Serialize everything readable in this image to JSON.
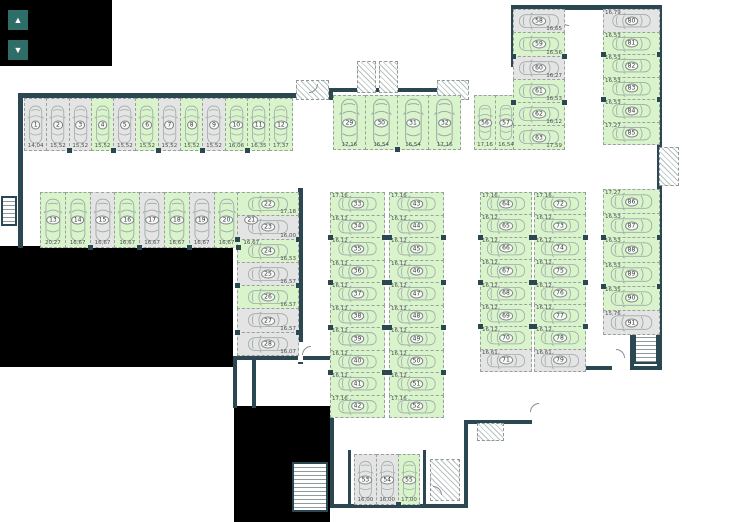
{
  "title": "underground-parking-floor-plan",
  "colors": {
    "wall": "#2b4751",
    "available": "#d9f3cb",
    "occupied": "#e4e4e4",
    "control_button": "#2f6e68",
    "background": "#ffffff"
  },
  "controls": {
    "up_glyph": "▲",
    "down_glyph": "▼"
  },
  "floor": {
    "groups": [
      {
        "id": "row1",
        "orient": "v",
        "stalls": [
          {
            "n": "1",
            "area": "14,04",
            "status": "occupied"
          },
          {
            "n": "2",
            "area": "15,52",
            "status": "occupied"
          },
          {
            "n": "3",
            "area": "15,52",
            "status": "occupied"
          },
          {
            "n": "4",
            "area": "15,52",
            "status": "available"
          },
          {
            "n": "5",
            "area": "15,52",
            "status": "occupied"
          },
          {
            "n": "6",
            "area": "15,52",
            "status": "available"
          },
          {
            "n": "7",
            "area": "15,52",
            "status": "occupied"
          },
          {
            "n": "8",
            "area": "15,52",
            "status": "available"
          },
          {
            "n": "9",
            "area": "15,52",
            "status": "occupied"
          },
          {
            "n": "10",
            "area": "16,06",
            "status": "available"
          },
          {
            "n": "11",
            "area": "16,35",
            "status": "available"
          },
          {
            "n": "12",
            "area": "17,37",
            "status": "available"
          }
        ]
      },
      {
        "id": "row2",
        "orient": "v",
        "stalls": [
          {
            "n": "13",
            "area": "20,27",
            "status": "available"
          },
          {
            "n": "14",
            "area": "16,67",
            "status": "available"
          },
          {
            "n": "15",
            "area": "16,67",
            "status": "occupied"
          },
          {
            "n": "16",
            "area": "16,67",
            "status": "available"
          },
          {
            "n": "17",
            "area": "16,67",
            "status": "occupied"
          },
          {
            "n": "18",
            "area": "16,67",
            "status": "available"
          },
          {
            "n": "19",
            "area": "16,67",
            "status": "occupied"
          },
          {
            "n": "20",
            "area": "16,67",
            "status": "available"
          },
          {
            "n": "21",
            "area": "16,67",
            "status": "occupied"
          }
        ]
      },
      {
        "id": "col22",
        "orient": "h",
        "stalls": [
          {
            "n": "22",
            "area": "17,18",
            "status": "available"
          },
          {
            "n": "23",
            "area": "16,00",
            "status": "occupied"
          },
          {
            "n": "24",
            "area": "16,53",
            "status": "available"
          },
          {
            "n": "25",
            "area": "16,57",
            "status": "occupied"
          },
          {
            "n": "26",
            "area": "16,57",
            "status": "available"
          },
          {
            "n": "27",
            "area": "16,57",
            "status": "occupied"
          },
          {
            "n": "28",
            "area": "16,07",
            "status": "occupied"
          }
        ]
      },
      {
        "id": "row29",
        "orient": "v",
        "stalls": [
          {
            "n": "29",
            "area": "17,16",
            "status": "available"
          },
          {
            "n": "30",
            "area": "16,54",
            "status": "available"
          },
          {
            "n": "31",
            "area": "16,54",
            "status": "available"
          },
          {
            "n": "32",
            "area": "17,16",
            "status": "available"
          }
        ]
      },
      {
        "id": "row56",
        "orient": "v",
        "stalls": [
          {
            "n": "56",
            "area": "17,16",
            "status": "available"
          },
          {
            "n": "57",
            "area": "16,54",
            "status": "available"
          }
        ]
      },
      {
        "id": "col58",
        "orient": "h",
        "stalls": [
          {
            "n": "58",
            "area": "16,65",
            "status": "occupied"
          },
          {
            "n": "59",
            "area": "16,56",
            "status": "available"
          },
          {
            "n": "60",
            "area": "16,27",
            "status": "occupied"
          },
          {
            "n": "61",
            "area": "16,53",
            "status": "available"
          },
          {
            "n": "62",
            "area": "16,12",
            "status": "available"
          },
          {
            "n": "63",
            "area": "17,59",
            "status": "available"
          }
        ]
      },
      {
        "id": "col80",
        "orient": "h",
        "stalls": [
          {
            "n": "80",
            "area": "16,79",
            "status": "occupied"
          },
          {
            "n": "81",
            "area": "16,53",
            "status": "available"
          },
          {
            "n": "82",
            "area": "16,53",
            "status": "available"
          },
          {
            "n": "83",
            "area": "16,53",
            "status": "available"
          },
          {
            "n": "84",
            "area": "16,53",
            "status": "available"
          },
          {
            "n": "85",
            "area": "17,27",
            "status": "available"
          }
        ]
      },
      {
        "id": "col33",
        "orient": "h",
        "stalls": [
          {
            "n": "33",
            "area": "17,16",
            "status": "available"
          },
          {
            "n": "34",
            "area": "16,12",
            "status": "available"
          },
          {
            "n": "35",
            "area": "16,12",
            "status": "available"
          },
          {
            "n": "36",
            "area": "16,12",
            "status": "available"
          },
          {
            "n": "37",
            "area": "16,12",
            "status": "available"
          },
          {
            "n": "38",
            "area": "16,12",
            "status": "available"
          },
          {
            "n": "39",
            "area": "16,12",
            "status": "available"
          },
          {
            "n": "40",
            "area": "16,12",
            "status": "available"
          },
          {
            "n": "41",
            "area": "16,12",
            "status": "available"
          },
          {
            "n": "42",
            "area": "17,16",
            "status": "available"
          }
        ]
      },
      {
        "id": "col43",
        "orient": "h",
        "stalls": [
          {
            "n": "43",
            "area": "17,16",
            "status": "available"
          },
          {
            "n": "44",
            "area": "16,12",
            "status": "available"
          },
          {
            "n": "45",
            "area": "16,12",
            "status": "available"
          },
          {
            "n": "46",
            "area": "16,12",
            "status": "available"
          },
          {
            "n": "47",
            "area": "16,12",
            "status": "available"
          },
          {
            "n": "48",
            "area": "16,12",
            "status": "available"
          },
          {
            "n": "49",
            "area": "16,12",
            "status": "available"
          },
          {
            "n": "50",
            "area": "16,12",
            "status": "available"
          },
          {
            "n": "51",
            "area": "16,12",
            "status": "available"
          },
          {
            "n": "52",
            "area": "17,16",
            "status": "available"
          }
        ]
      },
      {
        "id": "col64",
        "orient": "h",
        "stalls": [
          {
            "n": "64",
            "area": "17,16",
            "status": "available"
          },
          {
            "n": "65",
            "area": "16,12",
            "status": "available"
          },
          {
            "n": "66",
            "area": "16,12",
            "status": "available"
          },
          {
            "n": "67",
            "area": "16,12",
            "status": "available"
          },
          {
            "n": "68",
            "area": "16,12",
            "status": "available"
          },
          {
            "n": "69",
            "area": "16,12",
            "status": "available"
          },
          {
            "n": "70",
            "area": "16,12",
            "status": "available"
          },
          {
            "n": "71",
            "area": "16,61",
            "status": "occupied"
          }
        ]
      },
      {
        "id": "col72",
        "orient": "h",
        "stalls": [
          {
            "n": "72",
            "area": "17,16",
            "status": "available"
          },
          {
            "n": "73",
            "area": "16,12",
            "status": "available"
          },
          {
            "n": "74",
            "area": "16,12",
            "status": "available"
          },
          {
            "n": "75",
            "area": "16,12",
            "status": "available"
          },
          {
            "n": "76",
            "area": "16,12",
            "status": "available"
          },
          {
            "n": "77",
            "area": "16,12",
            "status": "available"
          },
          {
            "n": "78",
            "area": "16,12",
            "status": "available"
          },
          {
            "n": "79",
            "area": "16,61",
            "status": "occupied"
          }
        ]
      },
      {
        "id": "col86",
        "orient": "h",
        "stalls": [
          {
            "n": "86",
            "area": "17,27",
            "status": "available"
          },
          {
            "n": "87",
            "area": "16,53",
            "status": "available"
          },
          {
            "n": "88",
            "area": "16,53",
            "status": "available"
          },
          {
            "n": "89",
            "area": "16,53",
            "status": "available"
          },
          {
            "n": "90",
            "area": "16,35",
            "status": "available"
          },
          {
            "n": "91",
            "area": "15,76",
            "status": "occupied"
          }
        ]
      },
      {
        "id": "row53",
        "orient": "v",
        "stalls": [
          {
            "n": "53",
            "area": "16,00",
            "status": "occupied"
          },
          {
            "n": "54",
            "area": "16,00",
            "status": "occupied"
          },
          {
            "n": "55",
            "area": "17,00",
            "status": "available"
          }
        ]
      }
    ]
  }
}
